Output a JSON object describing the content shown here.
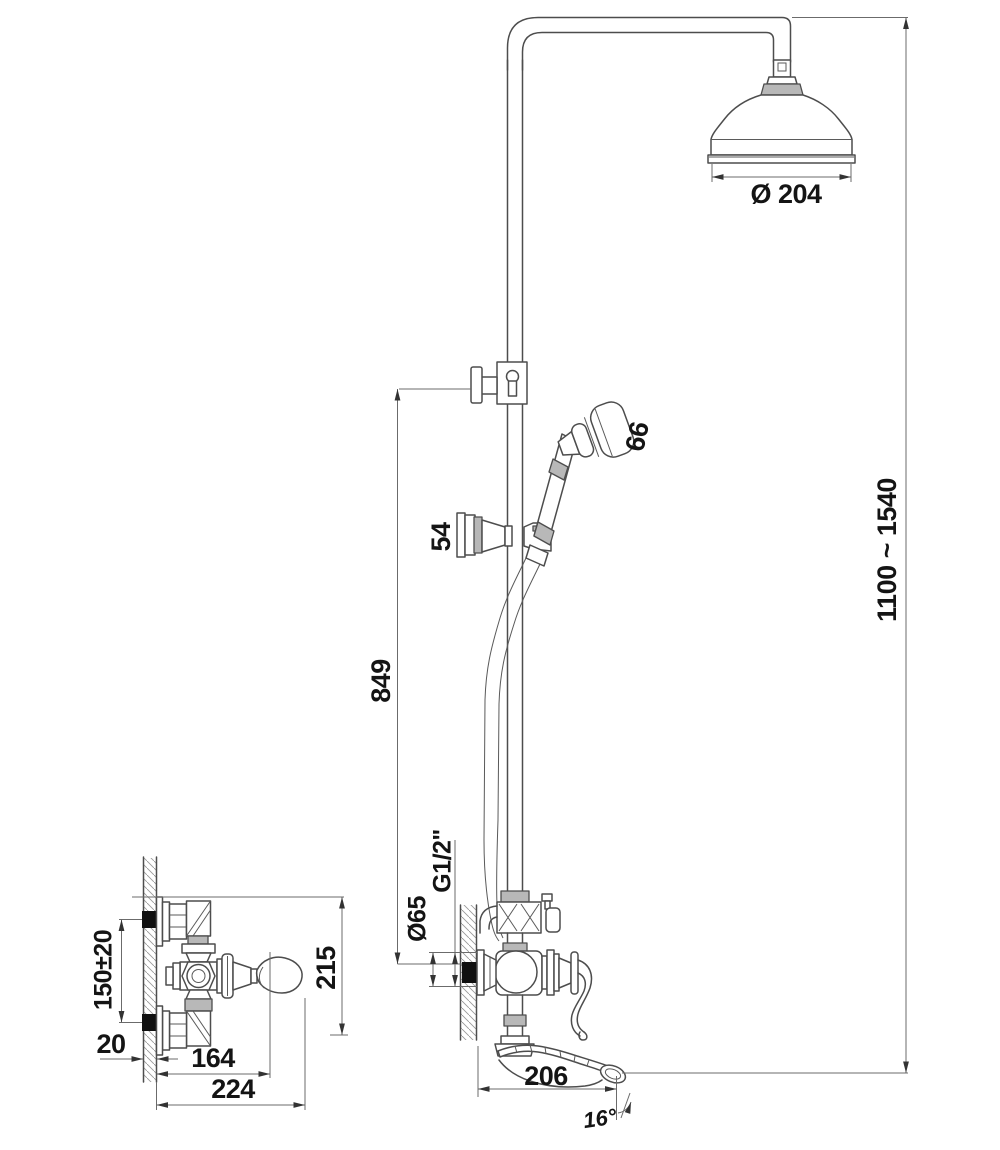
{
  "drawing": {
    "kind": "faucet shower column dimensional drawing",
    "colors": {
      "line": "#4d4d4d",
      "dimension_line": "#6b6b6b",
      "fill_gray": "#b8b8b8",
      "background": "#ffffff",
      "text": "#141414"
    }
  },
  "labels": {
    "head_diameter": "Ø 204",
    "overall_height": "1100 ~ 1540",
    "riser_height": "849",
    "handshower_head": "66",
    "holder_size": "54",
    "thread": "G1/2\"",
    "escutcheon_diameter": "Ø65",
    "spout_reach": "206",
    "spout_angle": "16°",
    "front_view": {
      "inlet_span": "150±20",
      "wall_thickness": "20",
      "reach_164": "164",
      "reach_224": "224",
      "height_215": "215"
    }
  }
}
